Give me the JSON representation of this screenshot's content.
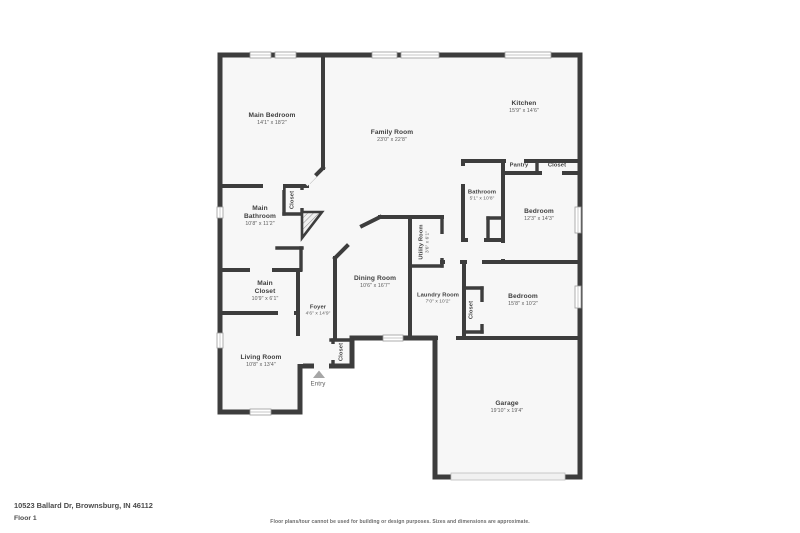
{
  "colors": {
    "wall": "#3d3d3d",
    "floor": "#f7f7f7",
    "window_border": "#9a9a9a",
    "label": "#3f3f3f",
    "dims": "#5a5a5a",
    "footer_text": "#4a4a4a",
    "disclaimer": "#6b6b6b",
    "entry_arrow": "#a6a6a6"
  },
  "floorplan": {
    "rooms": [
      {
        "id": "main-bedroom",
        "name": "Main Bedroom",
        "dims": "14'1\" x 18'2\"",
        "x": 272,
        "y": 119,
        "orientation": "horizontal",
        "size": "normal"
      },
      {
        "id": "family-room",
        "name": "Family Room",
        "dims": "23'0\" x 22'8\"",
        "x": 392,
        "y": 136,
        "orientation": "horizontal",
        "size": "normal"
      },
      {
        "id": "kitchen",
        "name": "Kitchen",
        "dims": "15'9\" x 14'6\"",
        "x": 524,
        "y": 107,
        "orientation": "horizontal",
        "size": "normal"
      },
      {
        "id": "pantry",
        "name": "Pantry",
        "dims": "",
        "x": 519,
        "y": 166,
        "orientation": "horizontal",
        "size": "small"
      },
      {
        "id": "kitchen-closet",
        "name": "Closet",
        "dims": "",
        "x": 557,
        "y": 166,
        "orientation": "horizontal",
        "size": "small"
      },
      {
        "id": "hall-bathroom",
        "name": "Bathroom",
        "dims": "5'1\" x 10'8\"",
        "x": 482,
        "y": 196,
        "orientation": "horizontal",
        "size": "small"
      },
      {
        "id": "bedroom-upper",
        "name": "Bedroom",
        "dims": "12'3\" x 14'3\"",
        "x": 539,
        "y": 215,
        "orientation": "horizontal",
        "size": "normal"
      },
      {
        "id": "main-bedroom-closet",
        "name": "Closet",
        "dims": "",
        "x": 293,
        "y": 200,
        "orientation": "vertical",
        "size": "small"
      },
      {
        "id": "main-bathroom",
        "name": "Main\nBathroom",
        "dims": "10'8\" x 11'2\"",
        "x": 260,
        "y": 216,
        "orientation": "horizontal",
        "size": "normal"
      },
      {
        "id": "main-closet",
        "name": "Main\nCloset",
        "dims": "10'9\" x 6'1\"",
        "x": 265,
        "y": 291,
        "orientation": "horizontal",
        "size": "normal"
      },
      {
        "id": "utility-room",
        "name": "Utility Room",
        "dims": "3'6\" x 6'1\"",
        "x": 425,
        "y": 242,
        "orientation": "vertical",
        "size": "small"
      },
      {
        "id": "dining-room",
        "name": "Dining Room",
        "dims": "10'6\" x 16'7\"",
        "x": 375,
        "y": 282,
        "orientation": "horizontal",
        "size": "normal"
      },
      {
        "id": "laundry-room",
        "name": "Laundry Room",
        "dims": "7'0\" x 10'2\"",
        "x": 438,
        "y": 299,
        "orientation": "horizontal",
        "size": "small"
      },
      {
        "id": "laundry-closet",
        "name": "Closet",
        "dims": "",
        "x": 472,
        "y": 310,
        "orientation": "vertical",
        "size": "small"
      },
      {
        "id": "bedroom-lower",
        "name": "Bedroom",
        "dims": "15'8\" x 10'2\"",
        "x": 523,
        "y": 300,
        "orientation": "horizontal",
        "size": "normal"
      },
      {
        "id": "foyer",
        "name": "Foyer",
        "dims": "4'6\" x 14'9\"",
        "x": 318,
        "y": 311,
        "orientation": "horizontal",
        "size": "small"
      },
      {
        "id": "entry-closet",
        "name": "Closet",
        "dims": "",
        "x": 342,
        "y": 352,
        "orientation": "vertical",
        "size": "small"
      },
      {
        "id": "living-room",
        "name": "Living Room",
        "dims": "10'8\" x 13'4\"",
        "x": 261,
        "y": 361,
        "orientation": "horizontal",
        "size": "normal"
      },
      {
        "id": "entry",
        "name": "Entry",
        "dims": "",
        "x": 318,
        "y": 384,
        "orientation": "horizontal",
        "size": "small",
        "style": "entry"
      },
      {
        "id": "garage",
        "name": "Garage",
        "dims": "19'10\" x 19'4\"",
        "x": 507,
        "y": 407,
        "orientation": "horizontal",
        "size": "normal"
      }
    ]
  },
  "footer": {
    "address": "10523 Ballard Dr, Brownsburg, IN 46112",
    "floor_label": "Floor 1",
    "disclaimer": "Floor plans/tour cannot be used for building or design purposes. Sizes and dimensions are approximate."
  }
}
